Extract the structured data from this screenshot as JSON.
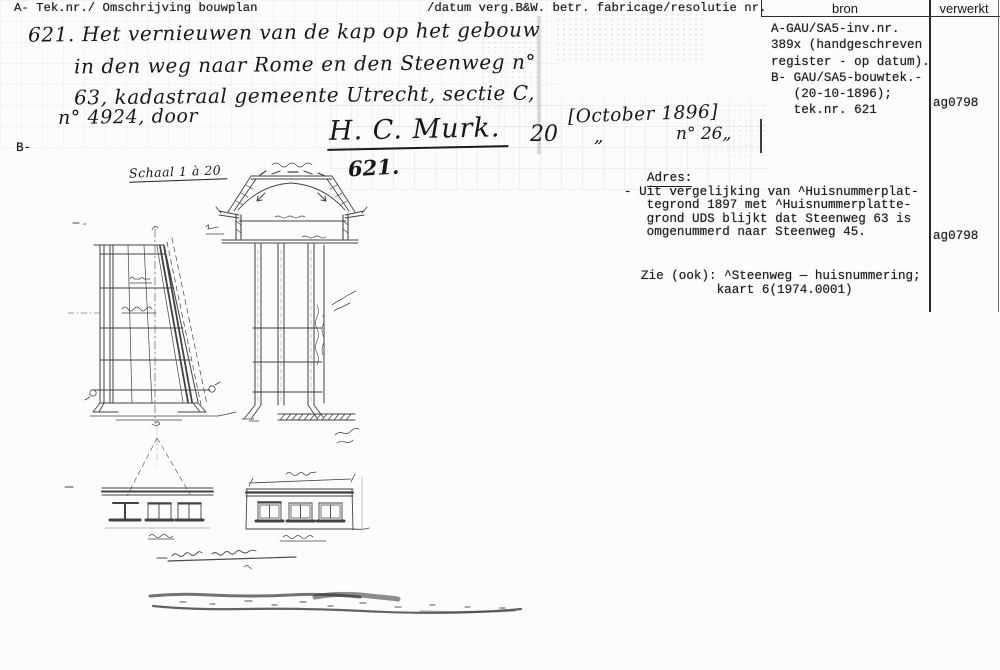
{
  "colors": {
    "ink": "#1c1c1c",
    "paper": "#fcfcfb",
    "rule_dark": "#2b2b2b",
    "rule_light": "#6e6e6e"
  },
  "form": {
    "header_left": "A- Tek.nr./ Omschrijving bouwplan",
    "header_middle": "/datum verg.B&W. betr. fabricage/resolutie nr.",
    "columns": {
      "bron": "bron",
      "verwerkt": "verwerkt"
    }
  },
  "bron_entry": {
    "lines": [
      "A-GAU/SA5-inv.nr.",
      "389x (handgeschreven",
      "register - op datum).",
      "B- GAU/SA5-bouwtek.-",
      "   (20-10-1896);",
      "   tek.nr. 621"
    ],
    "verwerkt": "ag0798"
  },
  "handwritten": {
    "line1": "621.  Het vernieuwen van de kap op het gebouw",
    "line2": "in den weg naar Rome en den Steenweg n°",
    "line3": "63, kadastraal gemeente Utrecht, sectie C,",
    "line4": "n° 4924, door",
    "signature": "H. C. Murk.",
    "day": "20",
    "month_bracketed": "[October 1896]",
    "ditto": "„",
    "resolutie_nr": "n° 26„",
    "tek_nr": "621.",
    "schaal": "Schaal 1 à 20"
  },
  "margin_label_b": "B-",
  "adres": {
    "title": "Adres:",
    "lines": [
      "- Uit vergelijking van ^Huisnummerplat-",
      "   tegrond 1897 met ^Huisnummerplatte-",
      "   grond UDS blijkt dat Steenweg 63 is",
      "   omgenummerd naar Steenweg 45."
    ],
    "verwerkt": "ag0798"
  },
  "zie": {
    "lines": [
      "Zie (ook): ^Steenweg — huisnummering;",
      "          kaart 6(1974.0001)"
    ]
  }
}
